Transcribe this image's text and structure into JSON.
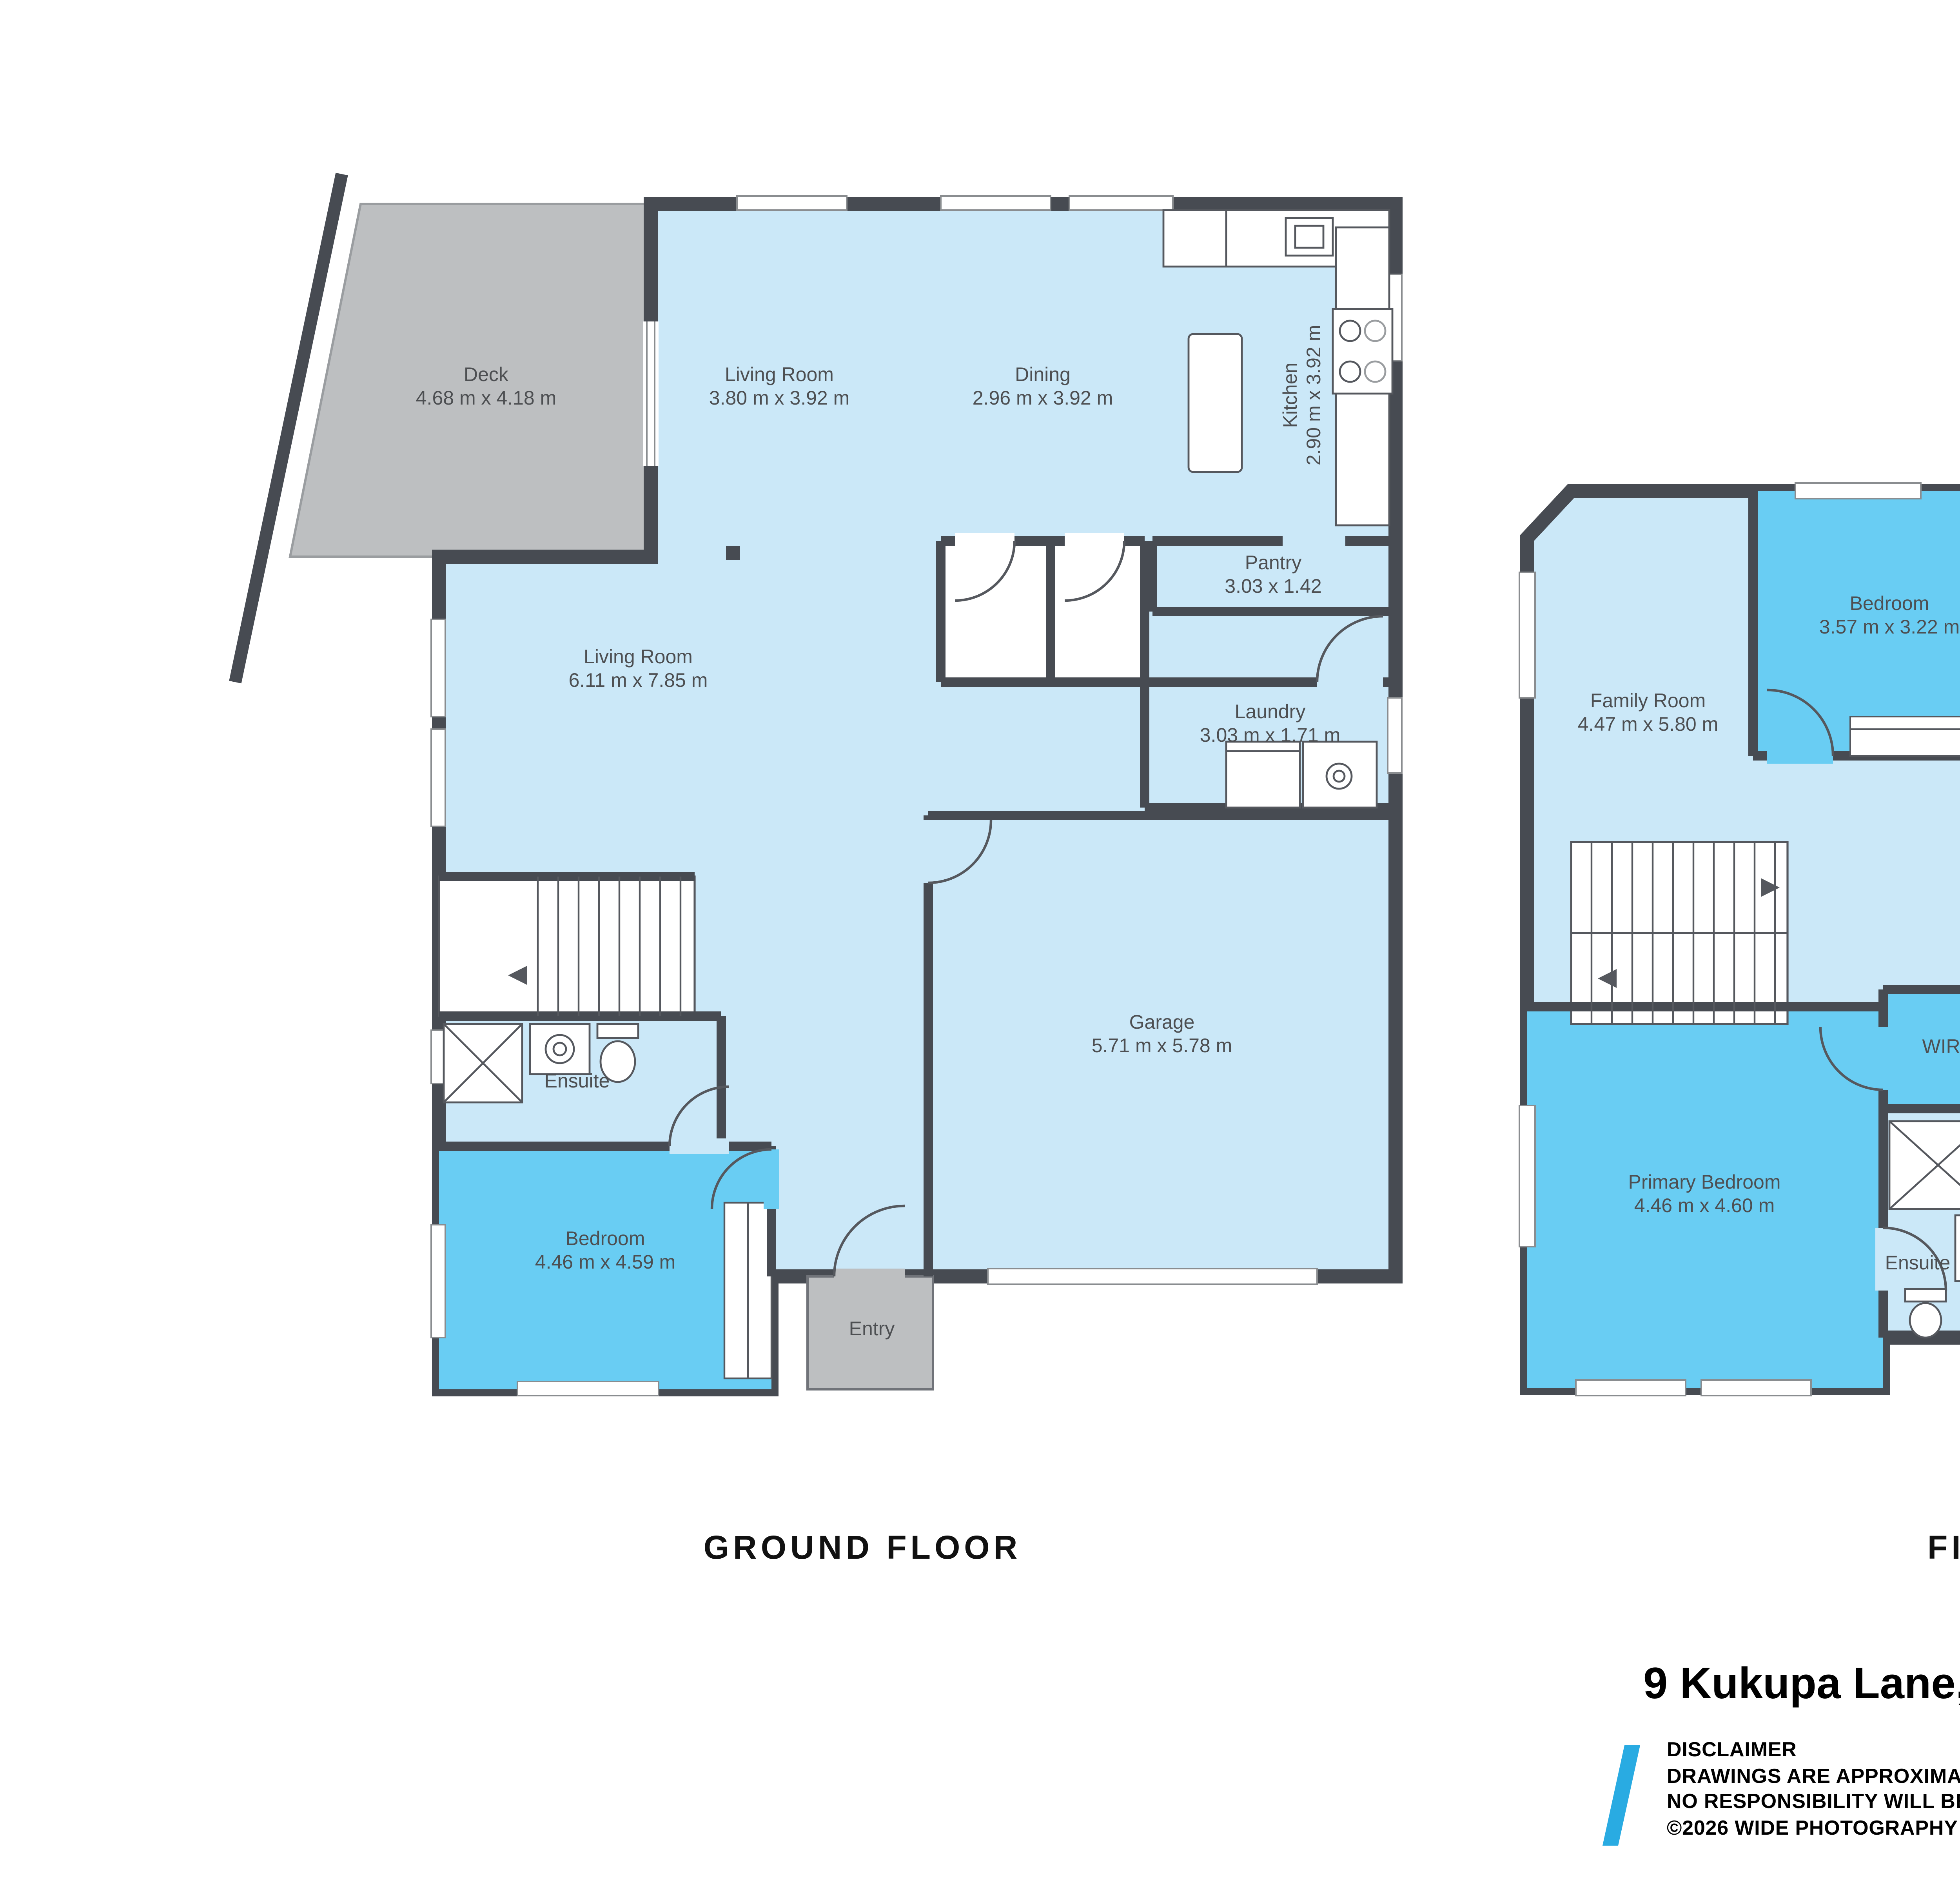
{
  "compass": {
    "north_label": "N"
  },
  "ground": {
    "title": "GROUND FLOOR",
    "deck": {
      "name": "Deck",
      "dims": "4.68 m x 4.18 m"
    },
    "living1": {
      "name": "Living Room",
      "dims": "3.80 m x 3.92 m"
    },
    "dining": {
      "name": "Dining",
      "dims": "2.96 m x 3.92 m"
    },
    "kitchen": {
      "name": "Kitchen",
      "dims": "2.90 m x 3.92 m"
    },
    "pantry": {
      "name": "Pantry",
      "dims": "3.03 x 1.42"
    },
    "living2": {
      "name": "Living Room",
      "dims": "6.11 m x 7.85 m"
    },
    "laundry": {
      "name": "Laundry",
      "dims": "3.03 m x 1.71 m"
    },
    "garage": {
      "name": "Garage",
      "dims": "5.71 m x 5.78 m"
    },
    "ensuite": {
      "name": "Ensuite"
    },
    "bedroom": {
      "name": "Bedroom",
      "dims": "4.46 m x 4.59 m"
    },
    "entry": {
      "name": "Entry"
    }
  },
  "first": {
    "title": "FIRST FLOOR",
    "family": {
      "name": "Family Room",
      "dims": "4.47 m x 5.80 m"
    },
    "bedroom1": {
      "name": "Bedroom",
      "dims": "3.57 m x 3.22 m"
    },
    "bedroom2": {
      "name": "Bedroom",
      "dims": "3.40 m x 3.23 m"
    },
    "bath": {
      "name": "Bath"
    },
    "office": {
      "name": "Office",
      "dims": "3.90 m x 3.84 m"
    },
    "bedroom3": {
      "name": "Bedroom",
      "dims": "3.40 m x 3.84 m"
    },
    "wir": {
      "name": "WIR"
    },
    "primary": {
      "name": "Primary Bedroom",
      "dims": "4.46 m x 4.60 m"
    },
    "ensuite": {
      "name": "Ensuite"
    }
  },
  "footer": {
    "address": "9 Kukupa Lane, Long Bay",
    "disclaimer_title": "DISCLAIMER",
    "disclaimer_line1": "DRAWINGS ARE APPROXIMATE AND FOR ILLUSTRATION PURPOSES ONLY",
    "disclaimer_line2": "NO RESPONSIBILITY WILL BE TAKEN FOR ANY OMISSIONS AND ERRORS.",
    "copyright": "©2026 WIDE PHOTOGRAPHY"
  },
  "colors": {
    "room_light_blue": "#cbe8f8",
    "room_medium_blue": "#69cdf3",
    "wall_dark": "#474b52",
    "deck_gray": "#bdbfc1",
    "accent_blue": "#29abe2",
    "label_gray": "#4d4f52",
    "compass_gray": "#8f9296"
  }
}
